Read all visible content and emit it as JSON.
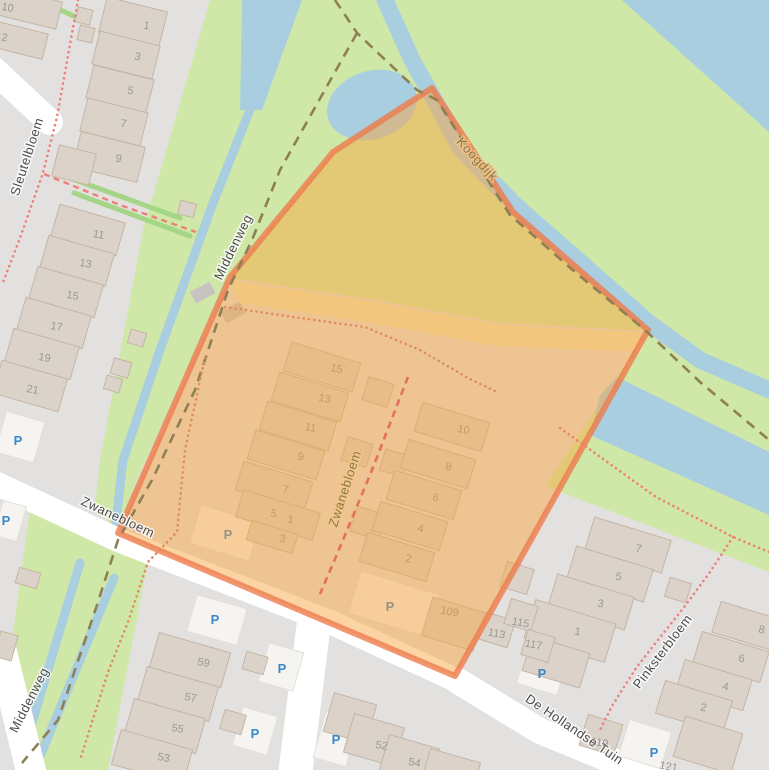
{
  "map": {
    "streets": {
      "sleutelbloem": "Sleutelbloem",
      "middenweg_top": "Middenweg",
      "middenweg_bottom": "Middenweg",
      "koogdijk": "Koogdijk",
      "zwanebloem_road": "Zwanebloem",
      "zwanebloem_inner": "Zwanebloem",
      "pinksterbloem": "Pinksterbloem",
      "de_hollandse_tuin": "De Hollandse Tuin"
    },
    "house_numbers": {
      "northwest_row": [
        "1",
        "3",
        "5",
        "7",
        "9",
        "10",
        "2"
      ],
      "west_block": [
        "11",
        "13",
        "15",
        "17",
        "19",
        "21"
      ],
      "inner_west": [
        "15",
        "13",
        "11",
        "9",
        "7",
        "5",
        "1",
        "3"
      ],
      "inner_east": [
        "10",
        "8",
        "6",
        "4",
        "2"
      ],
      "inner_other": [
        "109"
      ],
      "southwest_block": [
        "59",
        "57",
        "55",
        "53"
      ],
      "south_row": [
        "52",
        "54"
      ],
      "southeast_near": [
        "113",
        "115",
        "117",
        "119",
        "121"
      ],
      "southeast_block_a": [
        "1",
        "3",
        "5",
        "7"
      ],
      "southeast_block_b": [
        "2",
        "4",
        "6",
        "8"
      ]
    },
    "parking_label": "P",
    "colors": {
      "highlight_fill": "#F9A63E",
      "highlight_border": "#EC7C4E",
      "water": "#A9CEE0",
      "grass": "#CFE8A8",
      "farmland": "#ECE4B4",
      "residential": "#E3E1DF",
      "building": "#DBD3CA",
      "building_stroke": "#C4B5A4",
      "parking_blue": "#3A86C8",
      "footpath_red": "#EC8179",
      "track_brown": "#8F7F55"
    }
  }
}
